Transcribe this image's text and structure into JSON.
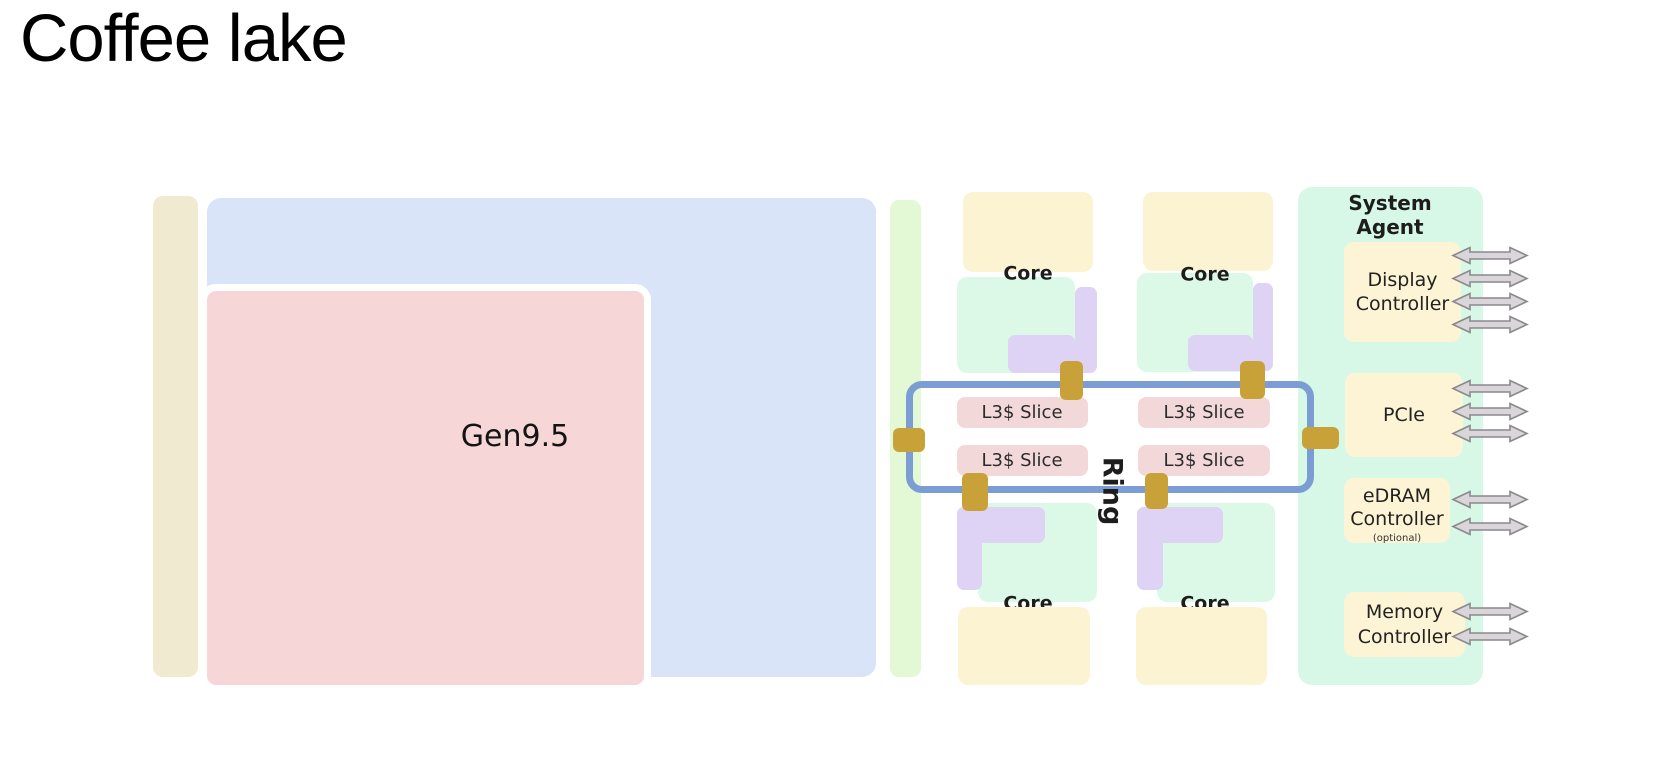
{
  "page_title": "Coffee lake",
  "gpu": {
    "label": "Gen9.5"
  },
  "cores": [
    {
      "label": "Core"
    },
    {
      "label": "Core"
    },
    {
      "label": "Core"
    },
    {
      "label": "Core"
    }
  ],
  "l3_slices": [
    {
      "label": "L3$ Slice"
    },
    {
      "label": "L3$ Slice"
    },
    {
      "label": "L3$ Slice"
    },
    {
      "label": "L3$ Slice"
    }
  ],
  "ring": {
    "label": "Ring"
  },
  "system_agent": {
    "title": "System\nAgent",
    "blocks": [
      {
        "label": "Display\nController",
        "arrows": 4
      },
      {
        "label": "PCIe",
        "arrows": 3
      },
      {
        "label": "eDRAM\nController",
        "note": "(optional)",
        "arrows": 2
      },
      {
        "label": "Memory\nController",
        "arrows": 2
      }
    ]
  },
  "colors": {
    "die_strip": "#f0ead0",
    "gpu_region": "#d9e4f8",
    "gpu_block": "#f7d6d8",
    "interconnect_strip": "#e3f8d5",
    "core_block": "#fcf3d3",
    "core_logic": "#dcf9e8",
    "core_cache": "#ded3f4",
    "l3_slice": "#f3d8da",
    "system_agent": "#d7f8e6",
    "io_block": "#fdf4d6",
    "ring_bus": "#7c9cd4",
    "ring_stop": "#c8a238",
    "arrow_fill": "#d9d5d9",
    "arrow_stroke": "#8b898d"
  }
}
